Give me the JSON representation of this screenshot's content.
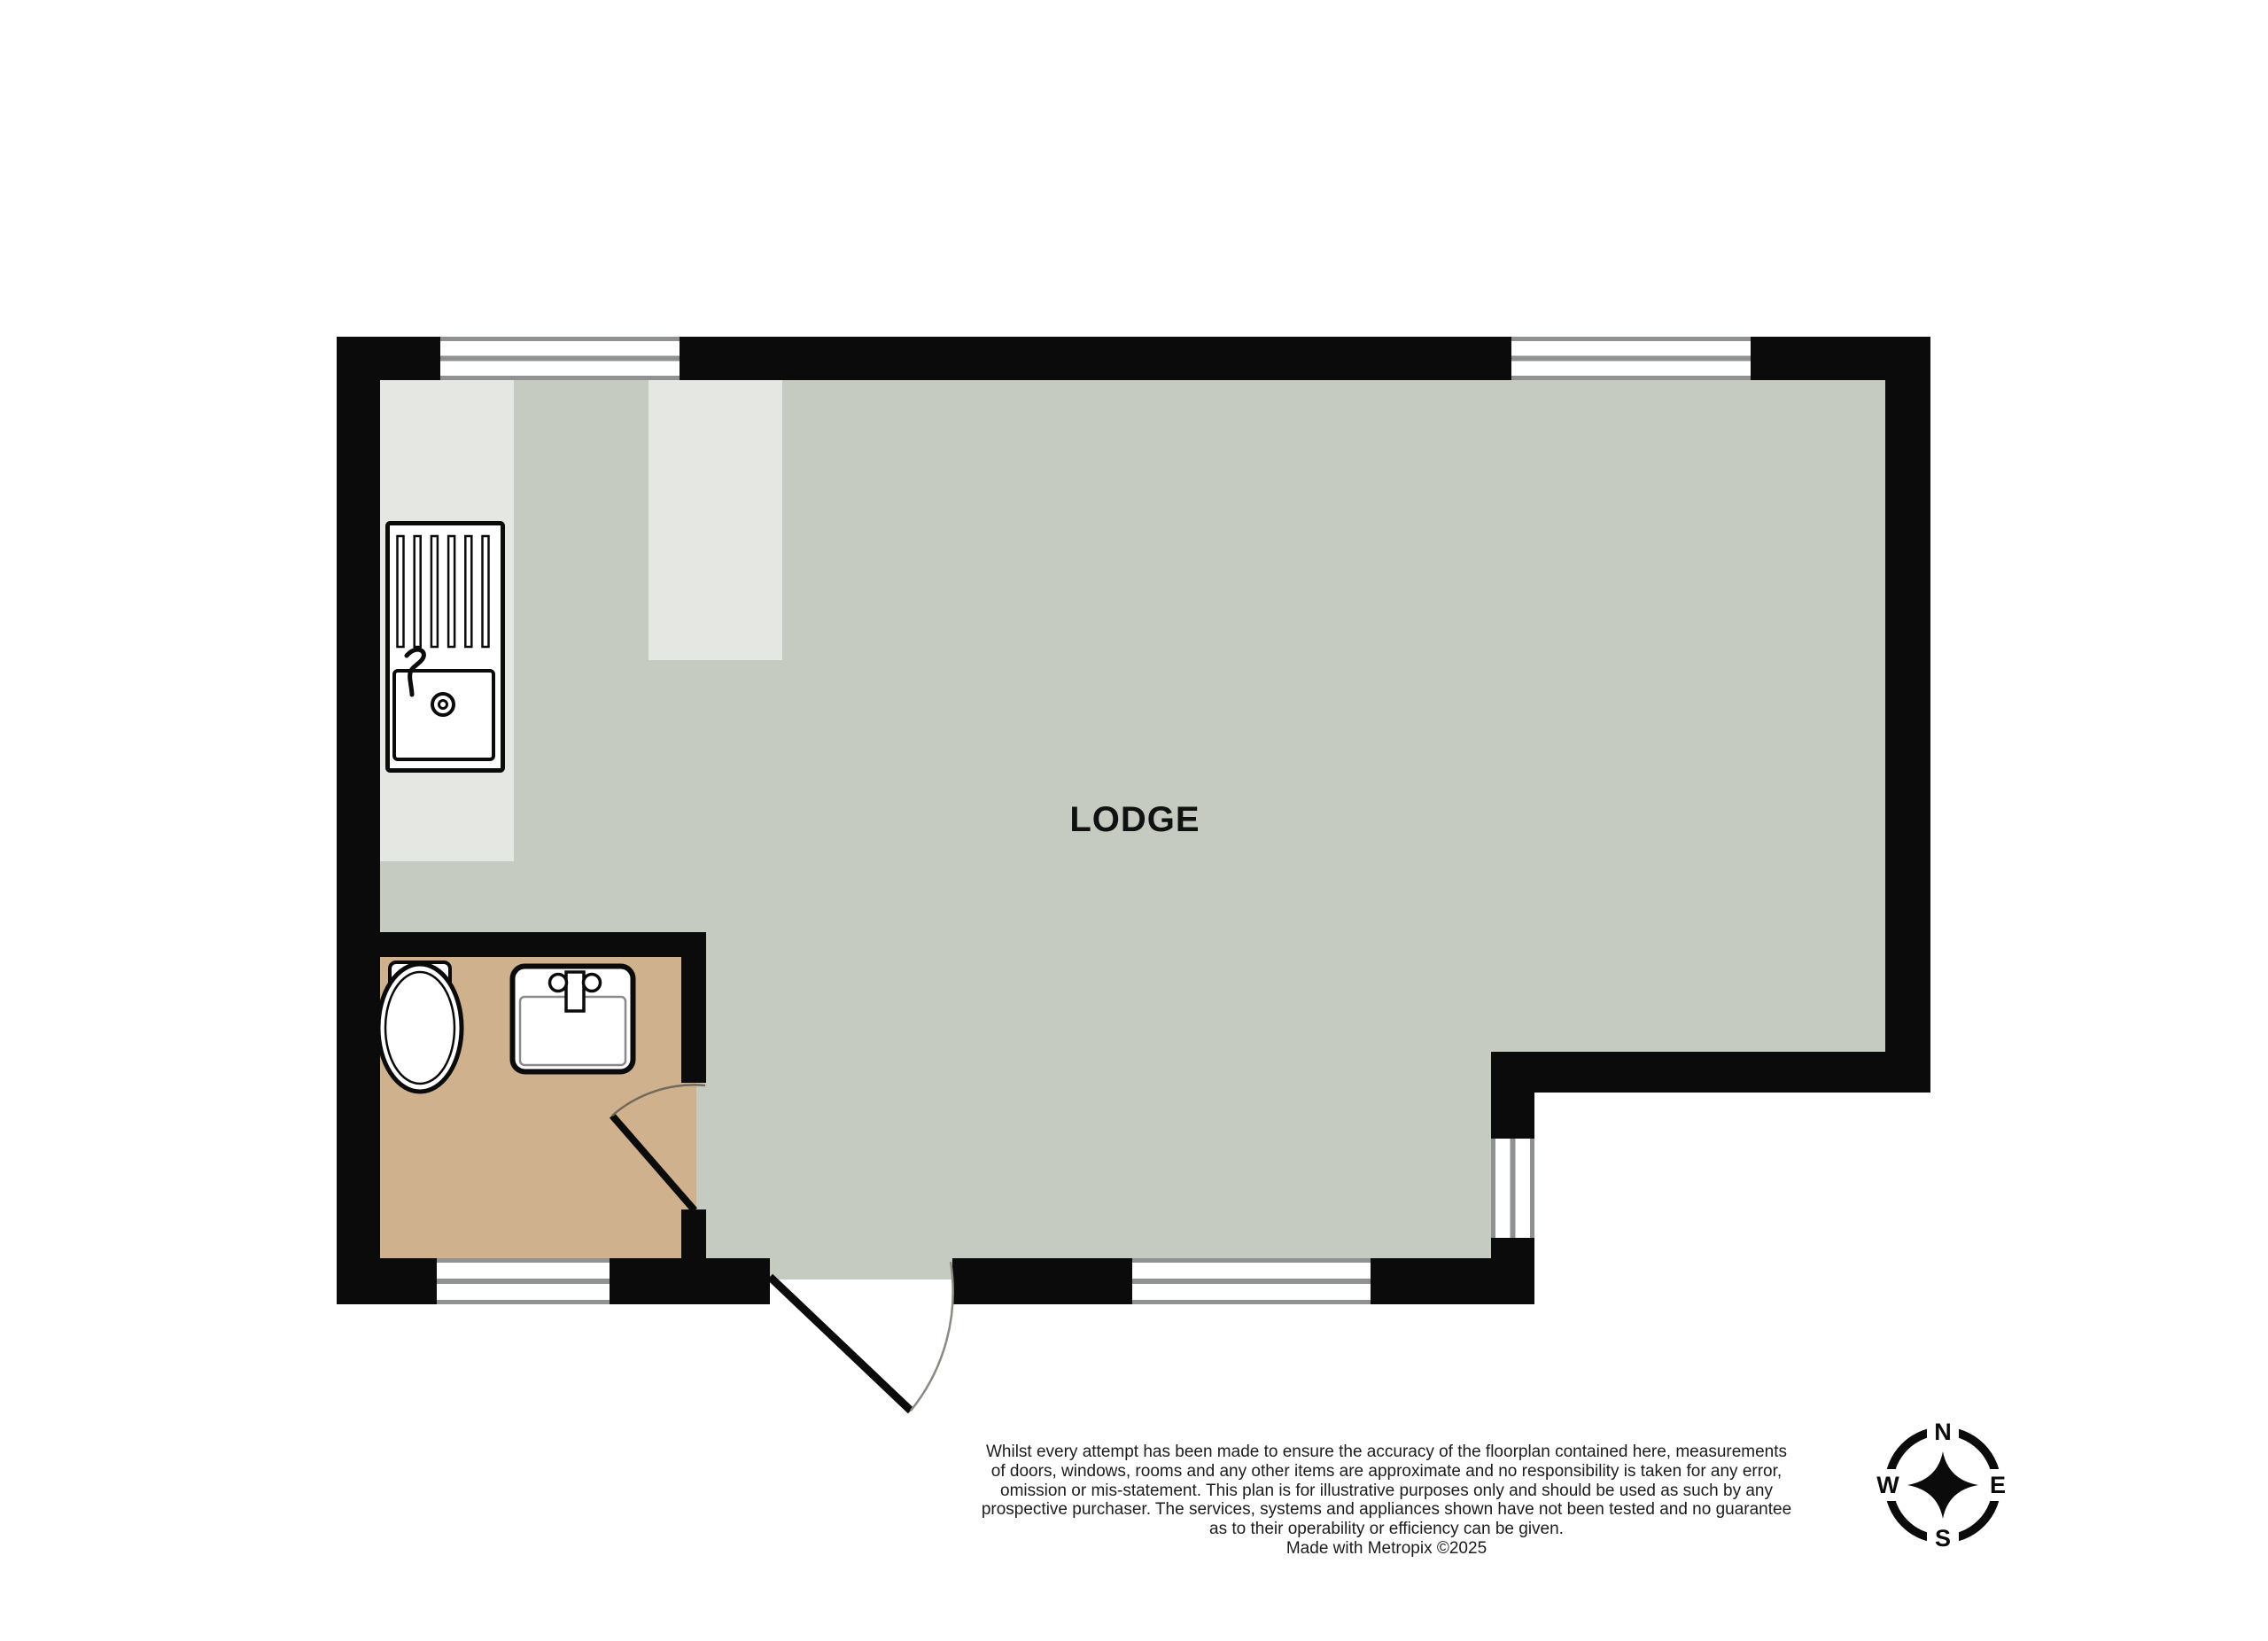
{
  "floorplan": {
    "room_label": "LODGE",
    "disclaimer": {
      "lines": [
        "Whilst every attempt has been made to ensure the accuracy of the floorplan contained here, measurements",
        "of doors, windows, rooms and any other items are approximate and no responsibility is taken for any error,",
        "omission or mis-statement. This plan is for illustrative purposes only and should be used as such by any",
        "prospective purchaser. The services, systems and appliances shown have not been tested and no guarantee",
        "as to their operability or efficiency can be given.",
        "Made with Metropix ©2025"
      ]
    },
    "compass": {
      "n": "N",
      "e": "E",
      "s": "S",
      "w": "W"
    },
    "colors": {
      "wall": "#0b0b0b",
      "floor": "#c5cbc0",
      "counter": "#e5e7e3",
      "bath_floor": "#d0b18d",
      "window_frame": "#8f9192",
      "text": "#1c1c1c",
      "fixture_stroke": "#0b0b0b"
    },
    "icons": {
      "kitchen_sink": "kitchen-sink-icon",
      "toilet": "toilet-icon",
      "basin": "bathroom-basin-icon",
      "compass": "compass-rose-icon",
      "doors": "door-swing-icon"
    }
  }
}
